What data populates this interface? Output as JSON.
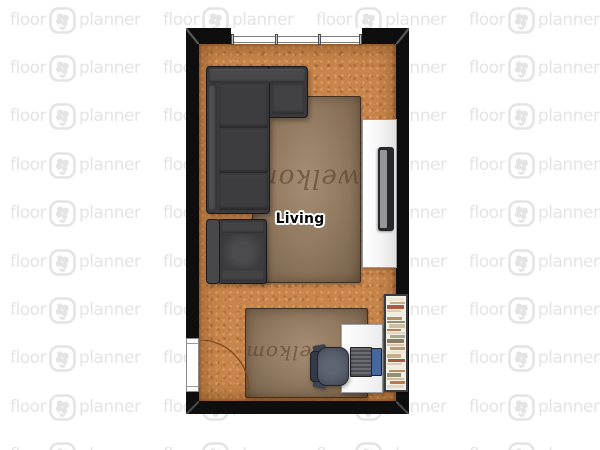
{
  "watermark": {
    "word_left": "floor",
    "word_right": "planner",
    "logo": "floorplanner-flower-logo",
    "color": "#e4e4e4"
  },
  "room": {
    "label": "Living"
  },
  "rugs": [
    {
      "text": "welkom"
    },
    {
      "text": "welkom"
    }
  ],
  "colors": {
    "background": "#ffffff",
    "watermark": "#e4e4e4",
    "wall": "#0e0e0e",
    "floor-base": "#c8854b",
    "rug-base": "#937b61",
    "rug-text": "#57432e",
    "rug-border": "#3f3022",
    "sofa-base": "#39393b",
    "sofa-outline": "#1a1a1c",
    "chair-seat": "#545a68",
    "laptop-screen": "#46689c",
    "cabinet-white": "#f7f7f7",
    "door-arc": "#7b4a1f",
    "label-text": "#000000"
  },
  "bookshelf": {
    "palette": [
      "#ece5d4",
      "#c5ae8a",
      "#aa5a40",
      "#d9cdb4",
      "#f1ece0",
      "#b29066",
      "#90906e",
      "#cdbfa4",
      "#bc7b4e",
      "#e0d6c2",
      "#a3ab90",
      "#8a7a64",
      "#d8c6a8",
      "#c09a6c"
    ]
  }
}
